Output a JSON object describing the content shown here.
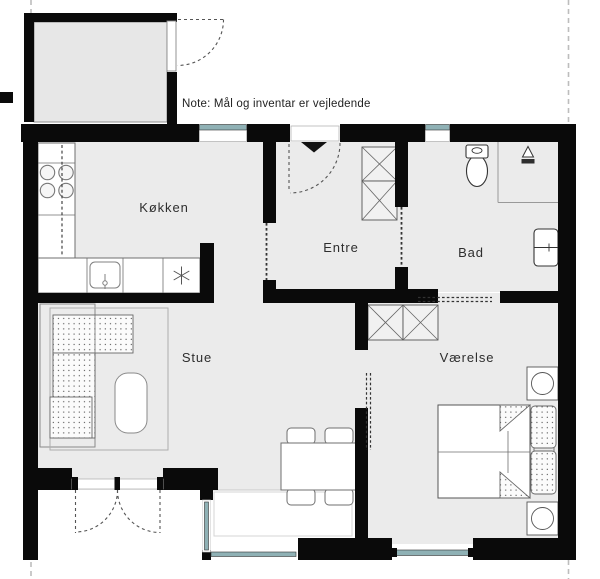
{
  "note": {
    "text": "Note: Mål og inventar er vejledende"
  },
  "rooms": {
    "koekken": {
      "label": "Køkken"
    },
    "entre": {
      "label": "Entre"
    },
    "bad": {
      "label": "Bad"
    },
    "stue": {
      "label": "Stue"
    },
    "vaerelse": {
      "label": "Værelse"
    }
  },
  "colors": {
    "wall": "#0a0a0a",
    "floor": "#ebebeb",
    "floor-depot": "#e7e7e7",
    "glass": "#8fb1b5",
    "outline": "#6f6f6f",
    "text": "#2e2e2e",
    "dashline": "#bdbdbd"
  }
}
